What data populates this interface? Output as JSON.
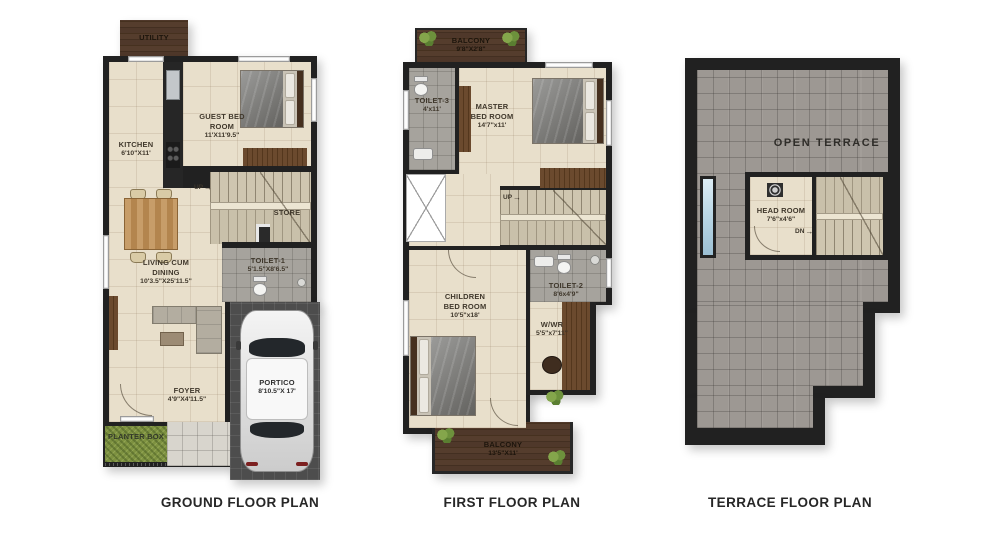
{
  "titles": {
    "ground": "GROUND FLOOR PLAN",
    "first": "FIRST FLOOR PLAN",
    "terrace": "TERRACE FLOOR PLAN"
  },
  "icons": {
    "arrow_right": "→"
  },
  "colors": {
    "wall": "#212121",
    "floor_beige": "#e8dfcb",
    "floor_gray": "#a6a39d",
    "terrace_tile": "#9d9893",
    "balcony_wood": "#4a3426",
    "wardrobe_wood": "#6b4a2e",
    "paving": "#4d4d4d",
    "grass": "#7d9140",
    "skylight": "#bcd8e6"
  },
  "ground": {
    "utility": {
      "name": "UTILITY"
    },
    "kitchen": {
      "name": "KITCHEN",
      "dims": "6'10\"X11'"
    },
    "guest": {
      "name": "GUEST BED ROOM",
      "dims": "11'X11'9.5\""
    },
    "store": {
      "name": "STORE"
    },
    "toilet1": {
      "name": "TOILET-1",
      "dims": "5'1.5\"X8'6.5\""
    },
    "living": {
      "name": "LIVING CUM DINING",
      "dims": "10'3.5\"X25'11.5\""
    },
    "foyer": {
      "name": "FOYER",
      "dims": "4'9\"X4'11.5\""
    },
    "planter": {
      "name": "PLANTER BOX"
    },
    "portico": {
      "name": "PORTICO",
      "dims": "8'10.5\"X 17'"
    },
    "up": "UP"
  },
  "first": {
    "balcony_top": {
      "name": "BALCONY",
      "dims": "9'8\"X2'8\""
    },
    "toilet3": {
      "name": "TOILET-3",
      "dims": "4'x11'"
    },
    "master": {
      "name": "MASTER BED ROOM",
      "dims": "14'7\"x11'"
    },
    "children": {
      "name": "CHILDREN BED ROOM",
      "dims": "10'5\"x18'"
    },
    "toilet2": {
      "name": "TOILET-2",
      "dims": "8'6x4'9\""
    },
    "wwr": {
      "name": "W/WR",
      "dims": "5'5\"x7'11\""
    },
    "balcony_bottom": {
      "name": "BALCONY",
      "dims": "13'5\"X11'"
    },
    "up": "UP"
  },
  "terrace": {
    "open_terrace": {
      "name": "OPEN TERRACE"
    },
    "head_room": {
      "name": "HEAD ROOM",
      "dims": "7'6\"x4'6\""
    },
    "dn": "DN"
  }
}
